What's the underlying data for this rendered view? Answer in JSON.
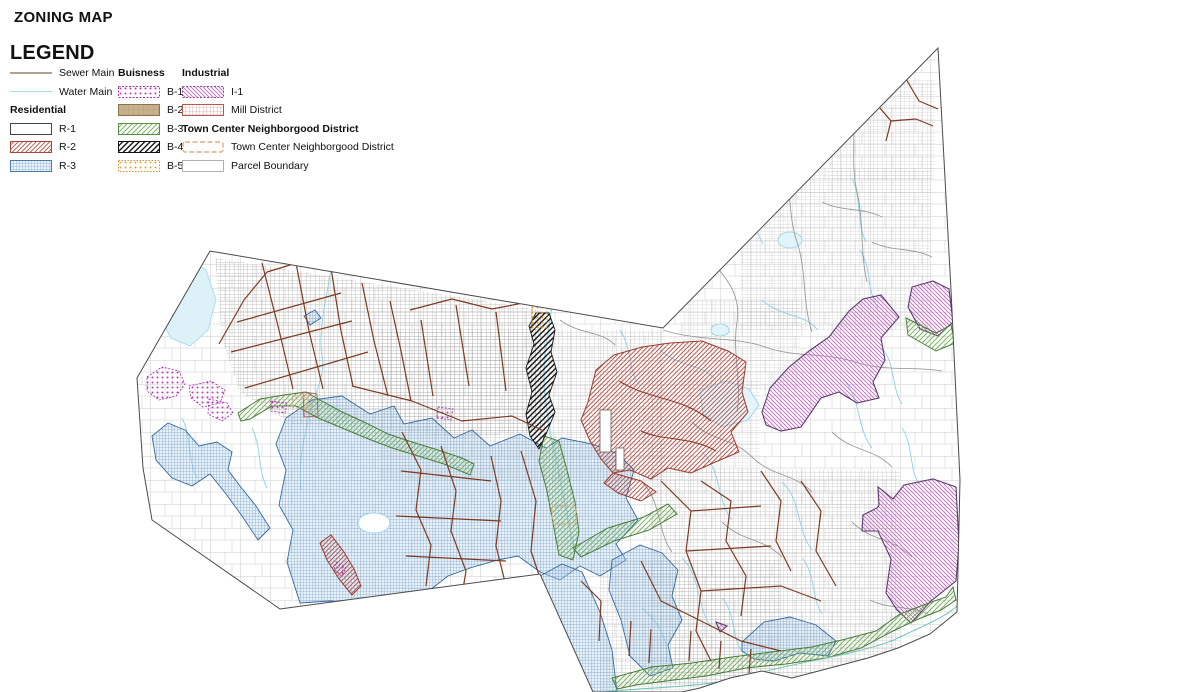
{
  "title": "ZONING MAP",
  "legend": {
    "heading": "LEGEND",
    "line_items": [
      {
        "id": "sewer-main",
        "label": "Sewer Main"
      },
      {
        "id": "water-main",
        "label": "Water Main"
      }
    ],
    "groups": [
      {
        "header": "Residential",
        "items": [
          {
            "id": "r1",
            "label": "R-1"
          },
          {
            "id": "r2",
            "label": "R-2"
          },
          {
            "id": "r3",
            "label": "R-3"
          }
        ]
      },
      {
        "header": "Buisness",
        "items": [
          {
            "id": "b1",
            "label": "B-1"
          },
          {
            "id": "b2",
            "label": "B-2"
          },
          {
            "id": "b3",
            "label": "B-3"
          },
          {
            "id": "b4",
            "label": "B-4"
          },
          {
            "id": "b5",
            "label": "B-5"
          }
        ]
      },
      {
        "header": "Industrial",
        "items": [
          {
            "id": "i1",
            "label": "I-1"
          },
          {
            "id": "mill",
            "label": "Mill District"
          }
        ]
      },
      {
        "header": "Town Center Neighborgood District",
        "items": [
          {
            "id": "tc",
            "label": "Town Center Neighborgood District"
          },
          {
            "id": "parcel",
            "label": "Parcel Boundary"
          }
        ]
      }
    ]
  },
  "colors": {
    "sewer_main_legend": "#b2a191",
    "sewer_main_map": "#7e3b22",
    "water_main": "#8ed1e6",
    "r2_hatch": "#b6483c",
    "r3_grid": "#5e93c4",
    "b1_dot": "#b83cb8",
    "b2_fill": "#c8b28c",
    "b3_hatch": "#7db463",
    "b4_hatch": "#161616",
    "b5_dot": "#dfa23a",
    "i1_hatch": "#c468c4",
    "mill_grid": "#cf837c",
    "tc_dash": "#dfae7e",
    "parcel_line": "#a8a8a8",
    "boundary": "#4a4a4a"
  }
}
